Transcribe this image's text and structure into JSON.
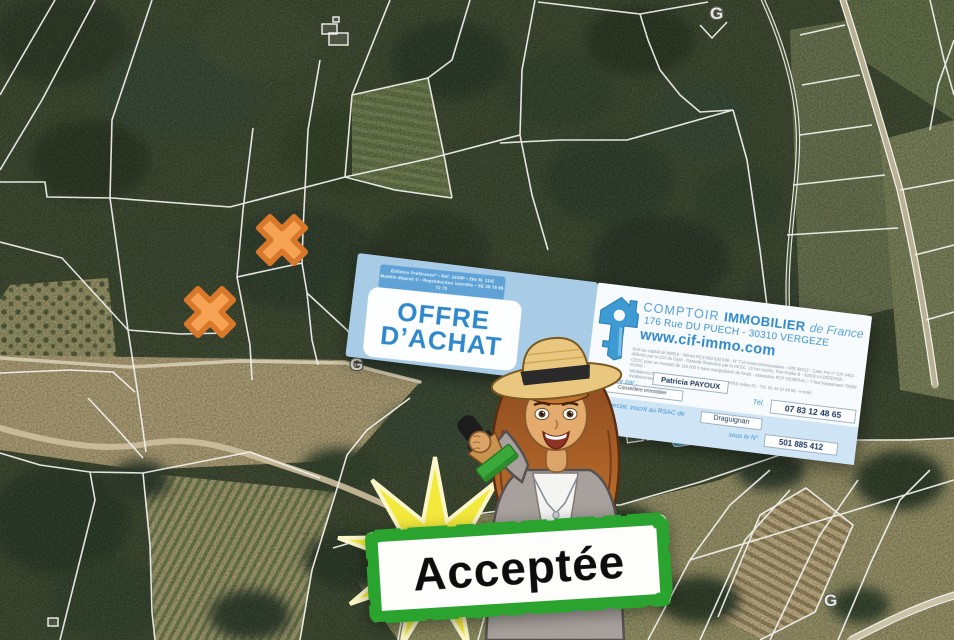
{
  "map": {
    "line_color": "#f2f2ee",
    "marker_color": "#f6a355",
    "section_labels": [
      {
        "text": "G"
      },
      {
        "text": "G"
      },
      {
        "text": "G"
      }
    ],
    "markers": [
      {
        "x": 282,
        "y": 240
      },
      {
        "x": 210,
        "y": 312
      }
    ]
  },
  "document": {
    "publisher_note": {
      "line1": "Éditions Préférence* • Réf. 3334P • 26e M. 11/E",
      "line2": "Modèle déposé © • Reproduction interdite • SE 39 75 95 72 72"
    },
    "title": {
      "line1": "OFFRE",
      "line2": "D’ACHAT"
    },
    "agency": {
      "brand": {
        "word1": "COMPTOIR",
        "word2": "IMMOBILIER",
        "word3": "de France"
      },
      "address": "176 Rue DU PUECH - 30310 VERGEZE",
      "website": "www.cif-immo.com",
      "legal_lines": {
        "l1": "SAS au capital de 8000 € - Nîmes RCS 953 520 539 - N° TVA intracommunautaire - APE 6831Z - Carte Pro n° CPI 3402 -",
        "l2": "délivrée par la CCI du Gard - Garantie financière par la CEGC, 16 rue Hoche, Tour Kupka B - 92919 LA DÉFENSE -",
        "l3": "CEGC pour un montant de 110 000 € sans manipulation de fonds - Assurance RCP GENERALI - 7 bvd Haussmann 75009 PARIS -",
        "l4": "Médiateurs Européens - 11 place Dauphine - 75053 PARIS cedex 01 - Tél. 01 44 32 49 56 - e-mail : mediateurseuropeens.org"
      },
      "presented_by_label": "présentée par :",
      "presented_by_name": "Patricia PAYOUX",
      "role": "Conseillère immobilier",
      "phone_label": "Tél.",
      "phone": "07 83 12 48 65",
      "rsac_label": "commercial, inscrit au RSAC de",
      "rsac_city": "Draguignan",
      "number_label": "sous le N°",
      "number": "501 885 412"
    }
  },
  "stamp": {
    "label": "Acceptée",
    "border_color": "#2aa32f",
    "text_color": "#0d0d0d"
  },
  "colors": {
    "agency_blue": "#2f88ca",
    "panel_blue": "#a9cce6",
    "starburst_yellow": "#f3e93c"
  }
}
